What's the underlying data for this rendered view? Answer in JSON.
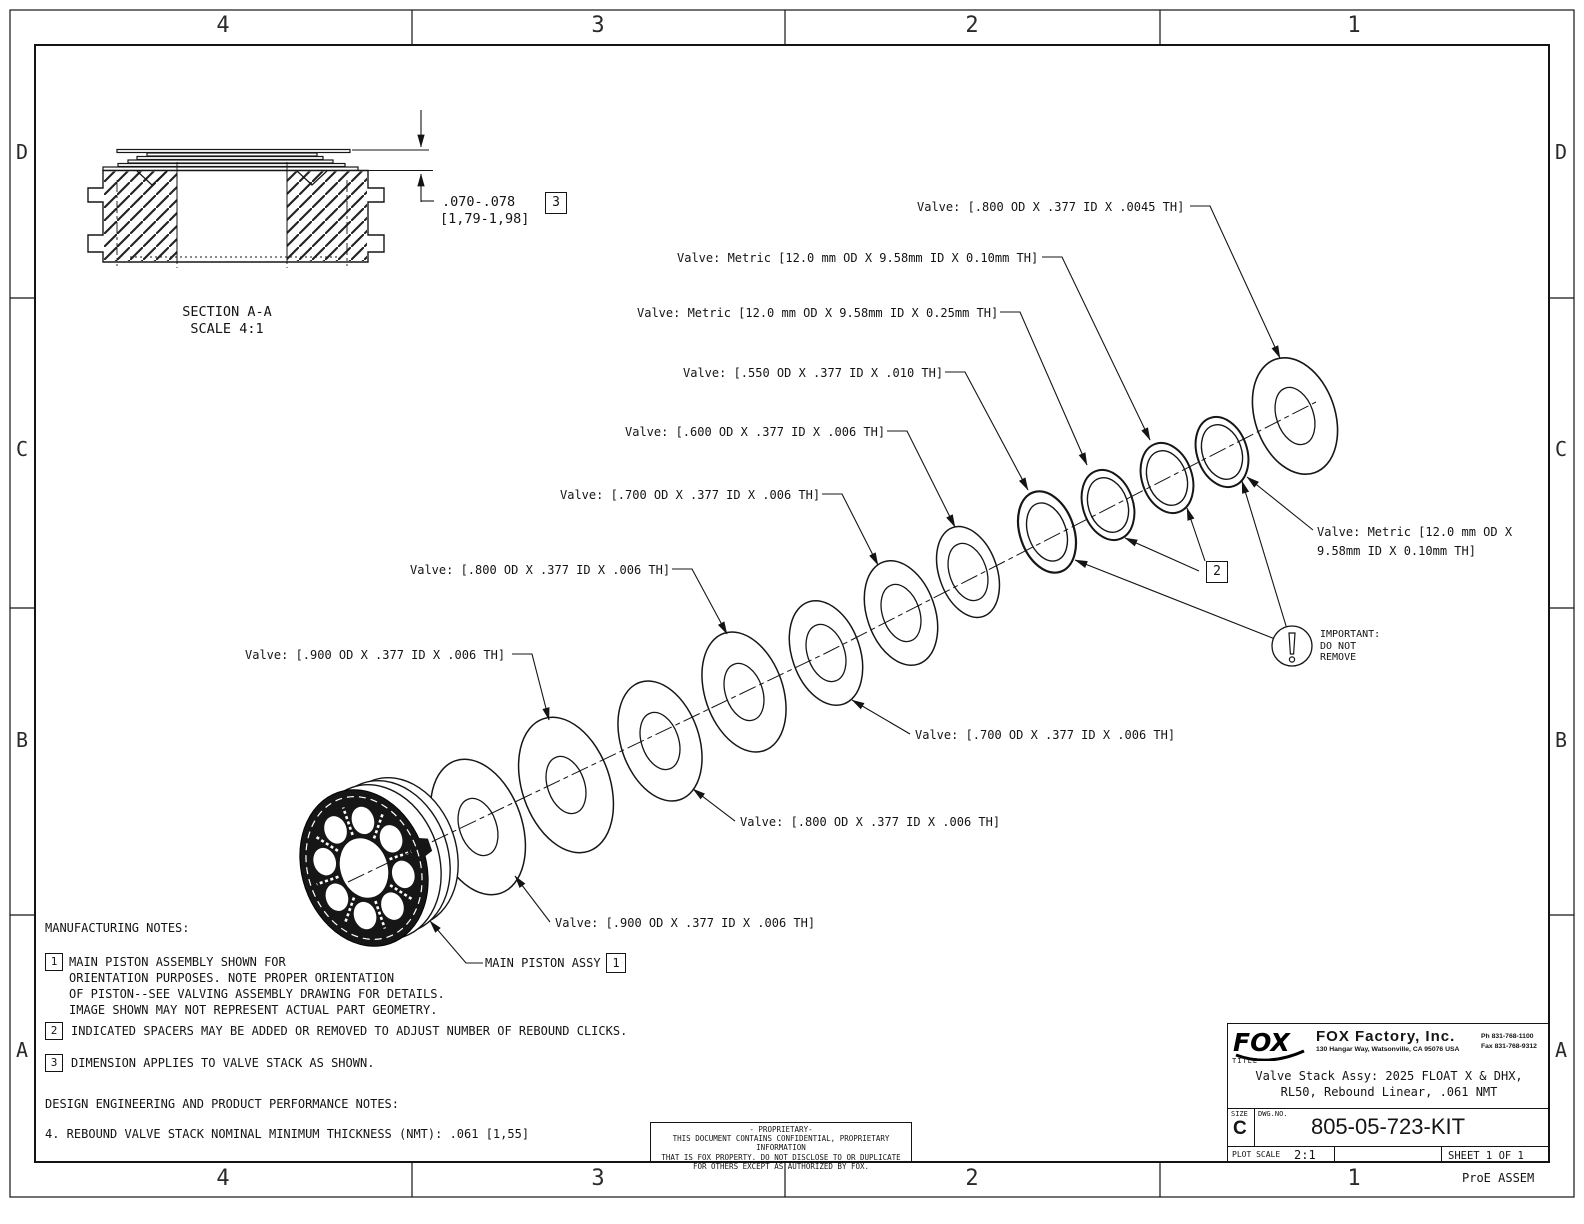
{
  "sheet": {
    "zones_top": [
      "4",
      "3",
      "2",
      "1"
    ],
    "zones_bottom": [
      "4",
      "3",
      "2",
      "1"
    ],
    "zones_left": [
      "D",
      "C",
      "B",
      "A"
    ],
    "zones_right": [
      "D",
      "C",
      "B",
      "A"
    ],
    "footer_note": "ProE ASSEM"
  },
  "section_view": {
    "caption_line1": "SECTION A-A",
    "caption_line2": "SCALE 4:1",
    "dim_inch": ".070-.078",
    "dim_mm": "[1,79-1,98]",
    "dim_flag": "3"
  },
  "callouts": {
    "valve_800_0045": "Valve: [.800 OD X .377 ID X .0045 TH]",
    "metric_010_top": "Valve: Metric [12.0 mm OD X 9.58mm ID X 0.10mm TH]",
    "metric_025": "Valve: Metric [12.0 mm OD X 9.58mm ID X 0.25mm TH]",
    "valve_550": "Valve: [.550 OD X .377 ID X .010 TH]",
    "valve_600": "Valve: [.600 OD X .377 ID X .006 TH]",
    "valve_700_left": "Valve: [.700 OD X .377 ID X .006 TH]",
    "valve_800_left": "Valve: [.800 OD X .377 ID X .006 TH]",
    "valve_900_left": "Valve: [.900 OD X .377 ID X .006 TH]",
    "valve_700_right": "Valve: [.700 OD X .377 ID X .006 TH]",
    "valve_800_bottom": "Valve: [.800 OD X .377 ID X .006 TH]",
    "valve_900_bottom": "Valve: [.900 OD X .377 ID X .006 TH]",
    "main_piston": "MAIN PISTON ASSY",
    "main_piston_flag": "1",
    "spacer_flag": "2",
    "metric_right_line1": "Valve: Metric [12.0 mm OD X",
    "metric_right_line2": "9.58mm ID X 0.10mm TH]",
    "important_line1": "IMPORTANT:",
    "important_line2": "DO NOT",
    "important_line3": "REMOVE"
  },
  "notes": {
    "mfg_heading": "MANUFACTURING NOTES:",
    "note1_flag": "1",
    "note1_line1": "MAIN PISTON ASSEMBLY SHOWN FOR",
    "note1_line2": "ORIENTATION PURPOSES. NOTE PROPER ORIENTATION",
    "note1_line3": "OF PISTON--SEE VALVING ASSEMBLY DRAWING FOR DETAILS.",
    "note1_line4": "IMAGE SHOWN MAY NOT REPRESENT ACTUAL PART GEOMETRY.",
    "note2_flag": "2",
    "note2_text": "INDICATED SPACERS MAY BE ADDED OR REMOVED TO ADJUST NUMBER OF REBOUND CLICKS.",
    "note3_flag": "3",
    "note3_text": "DIMENSION APPLIES TO VALVE STACK AS SHOWN.",
    "design_heading": "DESIGN ENGINEERING AND PRODUCT PERFORMANCE NOTES:",
    "note4_text": "4. REBOUND VALVE STACK NOMINAL MINIMUM THICKNESS (NMT): .061 [1,55]"
  },
  "proprietary": {
    "line1": "- PROPRIETARY-",
    "line2": "THIS DOCUMENT CONTAINS CONFIDENTIAL, PROPRIETARY INFORMATION",
    "line3": "THAT IS FOX PROPERTY.  DO NOT DISCLOSE TO OR DUPLICATE",
    "line4": "FOR OTHERS EXCEPT AS AUTHORIZED BY FOX."
  },
  "title_block": {
    "logo_text": "FOX",
    "company": "FOX Factory, Inc.",
    "address": "130 Hangar Way, Watsonville, CA 95076 USA",
    "phone": "Ph 831-768-1100",
    "fax": "Fax 831-768-9312",
    "title_label": "TITLE",
    "title_line1": "Valve Stack Assy: 2025 FLOAT X & DHX,",
    "title_line2": "RL50, Rebound Linear, .061 NMT",
    "size_label": "SIZE",
    "size_value": "C",
    "dwg_label": "DWG.NO.",
    "dwg_number": "805-05-723-KIT",
    "plot_scale_label": "PLOT SCALE",
    "plot_scale_value": "2:1",
    "sheet_value": "SHEET 1 OF 1"
  }
}
